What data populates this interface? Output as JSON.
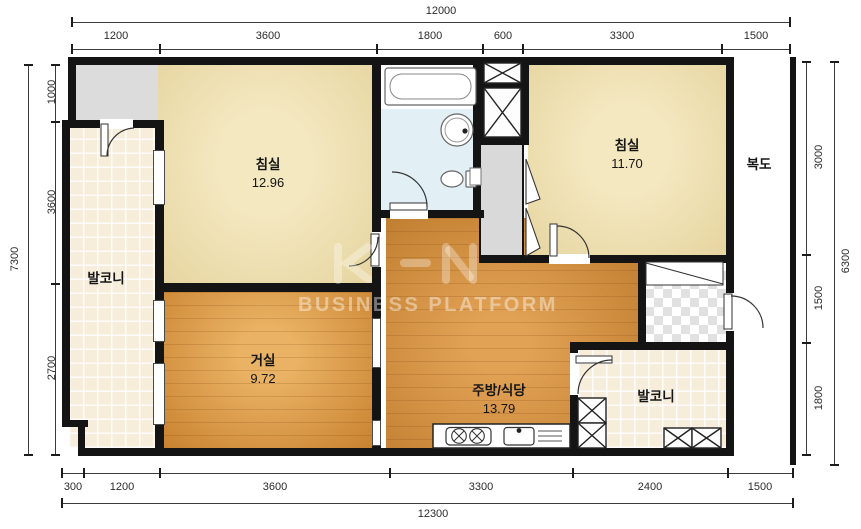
{
  "plan": {
    "type": "apartment-floor-plan",
    "watermark": {
      "logo": "KHN",
      "text": "BUSINESS PLATFORM"
    },
    "rooms": {
      "bedroom1": {
        "name": "침실",
        "area": "12.96"
      },
      "bedroom2": {
        "name": "침실",
        "area": "11.70"
      },
      "living": {
        "name": "거실",
        "area": "9.72"
      },
      "kitchen": {
        "name": "주방/식당",
        "area": "13.79"
      },
      "balcony_left": {
        "name": "발코니"
      },
      "balcony_right": {
        "name": "발코니"
      },
      "corridor": {
        "name": "복도"
      }
    },
    "dimensions": {
      "top": {
        "total": "12000",
        "segments": [
          "1200",
          "3600",
          "1800",
          "600",
          "3300",
          "1500"
        ]
      },
      "bottom": {
        "total": "12300",
        "segments": [
          "300",
          "1200",
          "3600",
          "3300",
          "2400",
          "1500"
        ]
      },
      "left": {
        "total": "7300",
        "segments": [
          "1000",
          "3600",
          "2700"
        ]
      },
      "right": {
        "total": "6300",
        "segments": [
          "3000",
          "1500",
          "1800"
        ]
      }
    },
    "colors": {
      "wall": "#141414",
      "bedroom_floor": "#eee0ad",
      "living_floor": "#d99750",
      "kitchen_floor": "#cd8b3e",
      "balcony_floor": "#f7eddb",
      "bathroom_floor": "#e2eff4",
      "gray_area": "#dcdcdc"
    }
  }
}
